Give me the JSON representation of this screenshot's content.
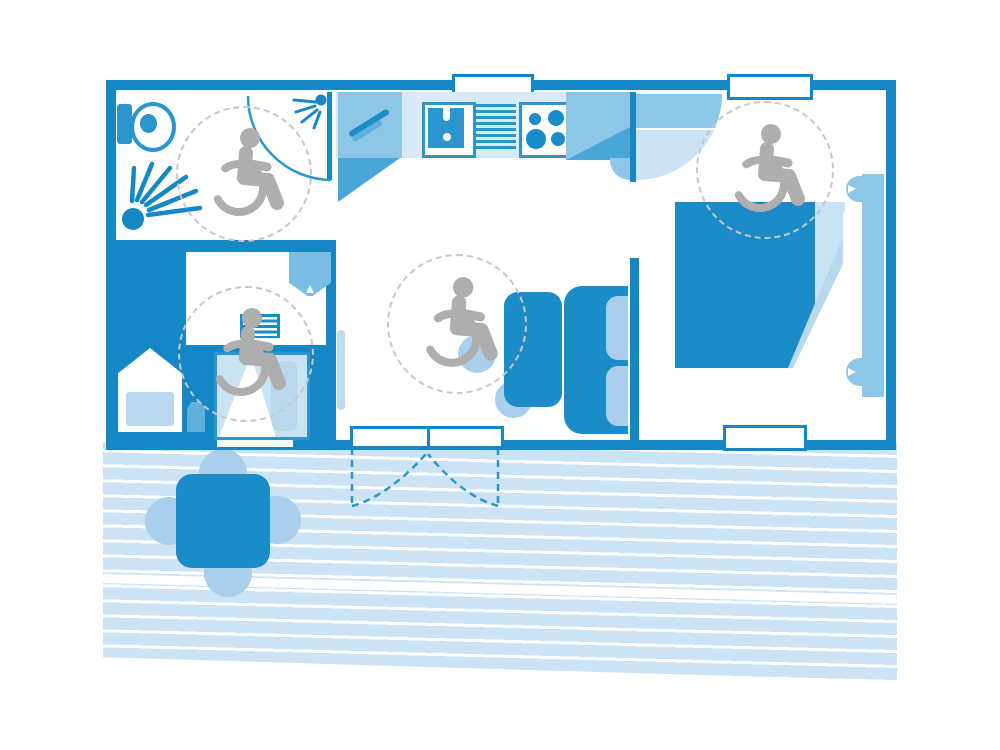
{
  "meta": {
    "diagram_type": "floor-plan",
    "subject": "accessible-mobile-home-with-terrace",
    "visible_text": ""
  },
  "colors": {
    "wall": "#1487c4",
    "furn": "#1b8cc7",
    "mid": "#8ec6e8",
    "soft": "#a9cfec",
    "plank": "#cbe3f5",
    "counter": "#d9eaf7",
    "pillow": "#c9e2f4",
    "gray": "#aeaeae",
    "dash": "#c4c8cb",
    "outline": "#2a95cf",
    "shadow": "#4aa6d8",
    "basin": "#79bce4",
    "lite": "#b9d8ee",
    "white": "#ffffff"
  },
  "rooms": [
    {
      "id": "bathroom",
      "accessible": true,
      "fixtures": [
        "toilet",
        "shower-spray",
        "door-with-swing",
        "wheelchair-turning-circle"
      ]
    },
    {
      "id": "kitchen",
      "accessible": false,
      "fixtures": [
        "counter",
        "left-cabinet",
        "sink-with-faucet",
        "drainer",
        "stove-four-burners",
        "right-cabinet",
        "window"
      ]
    },
    {
      "id": "small-bedroom",
      "accessible": true,
      "fixtures": [
        "single-bed",
        "wardrobe-block",
        "stool",
        "ladder",
        "washbasin",
        "sliding-door",
        "window",
        "wheelchair-turning-circle"
      ]
    },
    {
      "id": "living-room",
      "accessible": true,
      "fixtures": [
        "dining-table",
        "two-chairs",
        "sofa-with-cushions",
        "double-entry-door",
        "wheelchair-turning-circle"
      ]
    },
    {
      "id": "master-bedroom",
      "accessible": true,
      "fixtures": [
        "double-bed",
        "pillows",
        "headboard",
        "bed-side-tabs",
        "door-with-swing",
        "windows",
        "wheelchair-turning-circle"
      ]
    },
    {
      "id": "terrace",
      "accessible": true,
      "fixtures": [
        "plank-decking",
        "outdoor-table",
        "four-chairs",
        "door-swing-arcs"
      ]
    }
  ],
  "icons": [
    {
      "name": "wheelchair-accessible-icon",
      "count": 4
    },
    {
      "name": "shower-spray-icon",
      "count": 2
    },
    {
      "name": "toilet-icon",
      "count": 1
    }
  ],
  "windows": {
    "top": 2,
    "bottom": 2,
    "entry_door_leaves": 2
  }
}
